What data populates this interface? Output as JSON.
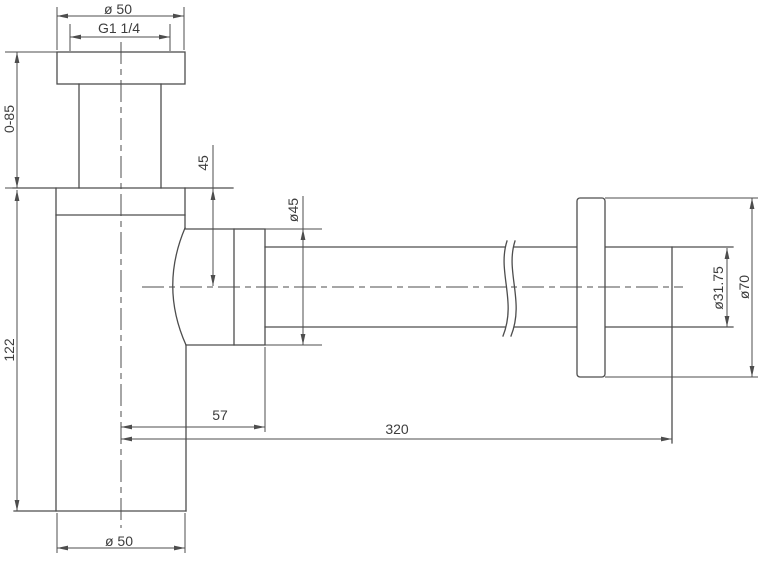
{
  "colors": {
    "background": "#ffffff",
    "line": "#4d4d4d",
    "text": "#3d3d3d"
  },
  "drawing": {
    "dimensions": {
      "top_diameter": "ø 50",
      "thread_size": "G1 1/4",
      "inlet_height_range": "0-85",
      "outlet_drop": "45",
      "nut_diameter": "ø45",
      "body_height": "122",
      "pipe_diameter": "ø31.75",
      "flange_diameter": "ø70",
      "outlet_offset": "57",
      "pipe_length": "320",
      "bottom_diameter": "ø 50"
    }
  }
}
